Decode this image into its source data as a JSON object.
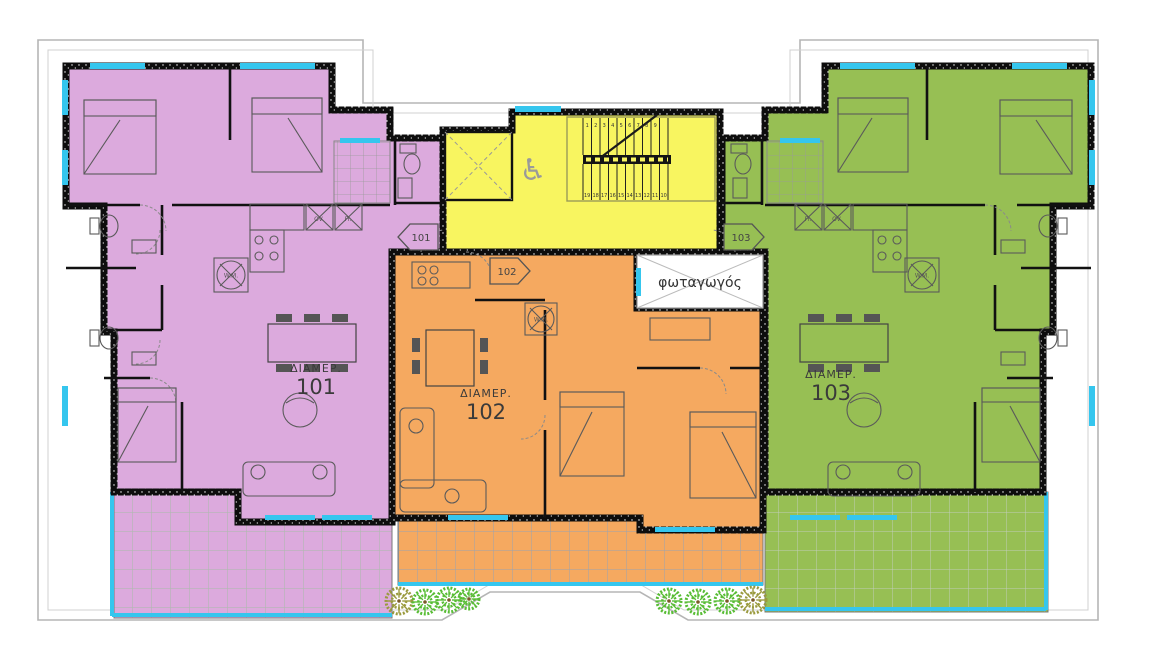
{
  "plan_title": "apartment-floor-plan",
  "colors": {
    "apartment_101": "#dcaadd",
    "apartment_102": "#f5a960",
    "apartment_103": "#97bf54",
    "stairwell": "#f8f560",
    "light_well": "#ffffff",
    "window_glass": "#35c6ee",
    "wall": "#0d0d0d",
    "boundary_line": "#b5b5b5"
  },
  "apartments": [
    {
      "label": "ΔΙΑΜΕΡ.",
      "number": "101"
    },
    {
      "label": "ΔΙΑΜΕΡ.",
      "number": "102"
    },
    {
      "label": "ΔΙΑΜΕΡ.",
      "number": "103"
    }
  ],
  "entrance_tags": {
    "a101": "101",
    "a102": "102",
    "a103": "103"
  },
  "light_well": {
    "label": "φωταγωγός"
  },
  "appliances": {
    "washing_machine": "W.M.",
    "oven": "OV.",
    "fridge": "Fr."
  },
  "stairs": {
    "top_run": [
      "1",
      "2",
      "3",
      "4",
      "5",
      "6",
      "7",
      "8",
      "9"
    ],
    "bottom_run": [
      "19",
      "18",
      "17",
      "16",
      "15",
      "14",
      "13",
      "12",
      "11",
      "10"
    ]
  },
  "accessibility": {
    "wheelchair_symbol": "♿"
  },
  "plants": [
    {
      "x": 399,
      "y": 601,
      "r": 13,
      "c": "#9a9a3e"
    },
    {
      "x": 425,
      "y": 602,
      "r": 12,
      "c": "#58bd35"
    },
    {
      "x": 449,
      "y": 600,
      "r": 12,
      "c": "#58bd35"
    },
    {
      "x": 469,
      "y": 599,
      "r": 10,
      "c": "#58bd35"
    },
    {
      "x": 669,
      "y": 601,
      "r": 12,
      "c": "#58bd35"
    },
    {
      "x": 698,
      "y": 602,
      "r": 12,
      "c": "#58bd35"
    },
    {
      "x": 727,
      "y": 601,
      "r": 12,
      "c": "#58bd35"
    },
    {
      "x": 753,
      "y": 600,
      "r": 13,
      "c": "#9a9a3e"
    }
  ]
}
